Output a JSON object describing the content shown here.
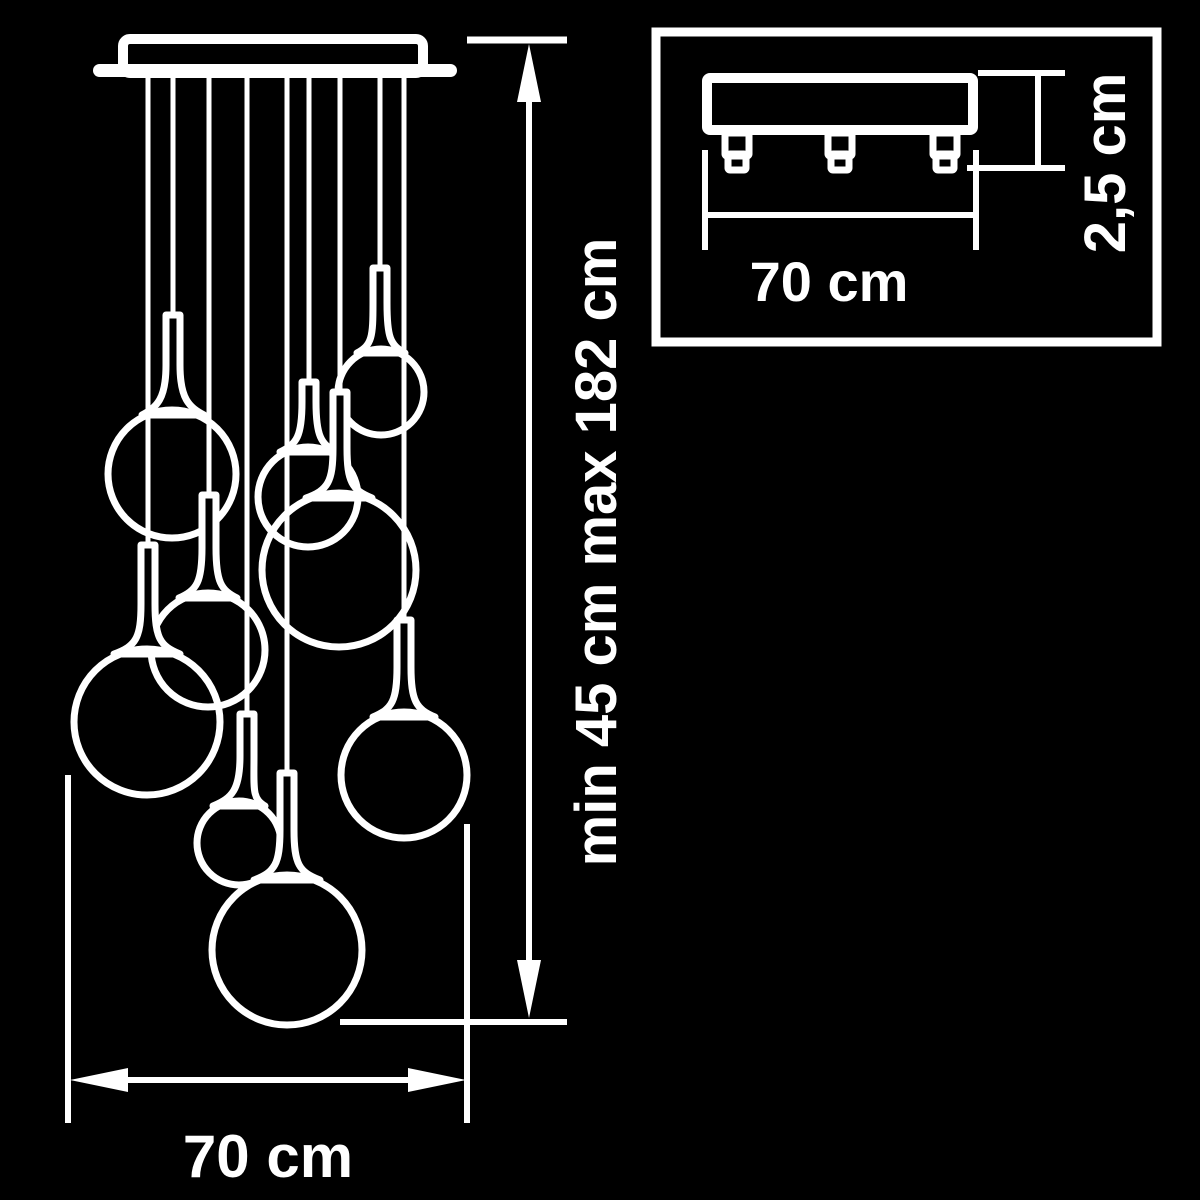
{
  "scene": {
    "background_color": "#000000",
    "line_color": "#ffffff",
    "description": "Technical dimension drawing of a 9-globe cascade pendant lamp with ceiling mount inset"
  },
  "main_view": {
    "globe_count": 9,
    "height_dimension_label": "min 45 cm max 182 cm",
    "width_dimension_label": "70 cm"
  },
  "inset_view": {
    "width_dimension_label": "70 cm",
    "thickness_dimension_label": "2,5 cm"
  }
}
